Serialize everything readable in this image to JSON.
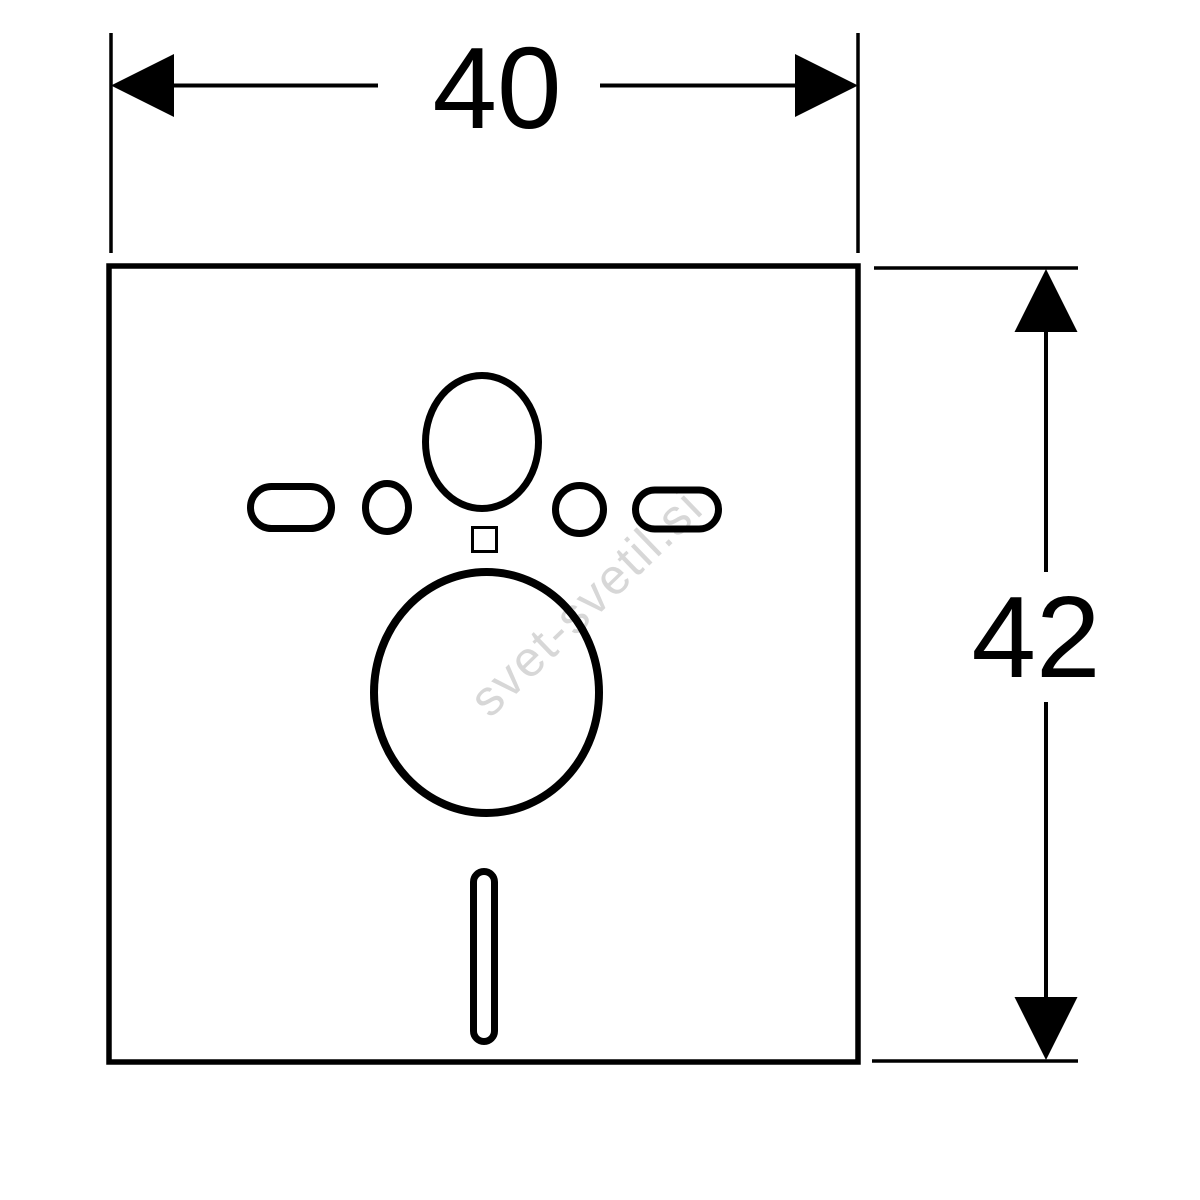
{
  "colors": {
    "background": "#ffffff",
    "line": "#000000",
    "fill": "#ffffff",
    "watermark": "#d7d7d7"
  },
  "dimensions": {
    "width": {
      "label": "40"
    },
    "height": {
      "label": "42"
    }
  },
  "watermark": {
    "text": "svet-svetil.si"
  }
}
